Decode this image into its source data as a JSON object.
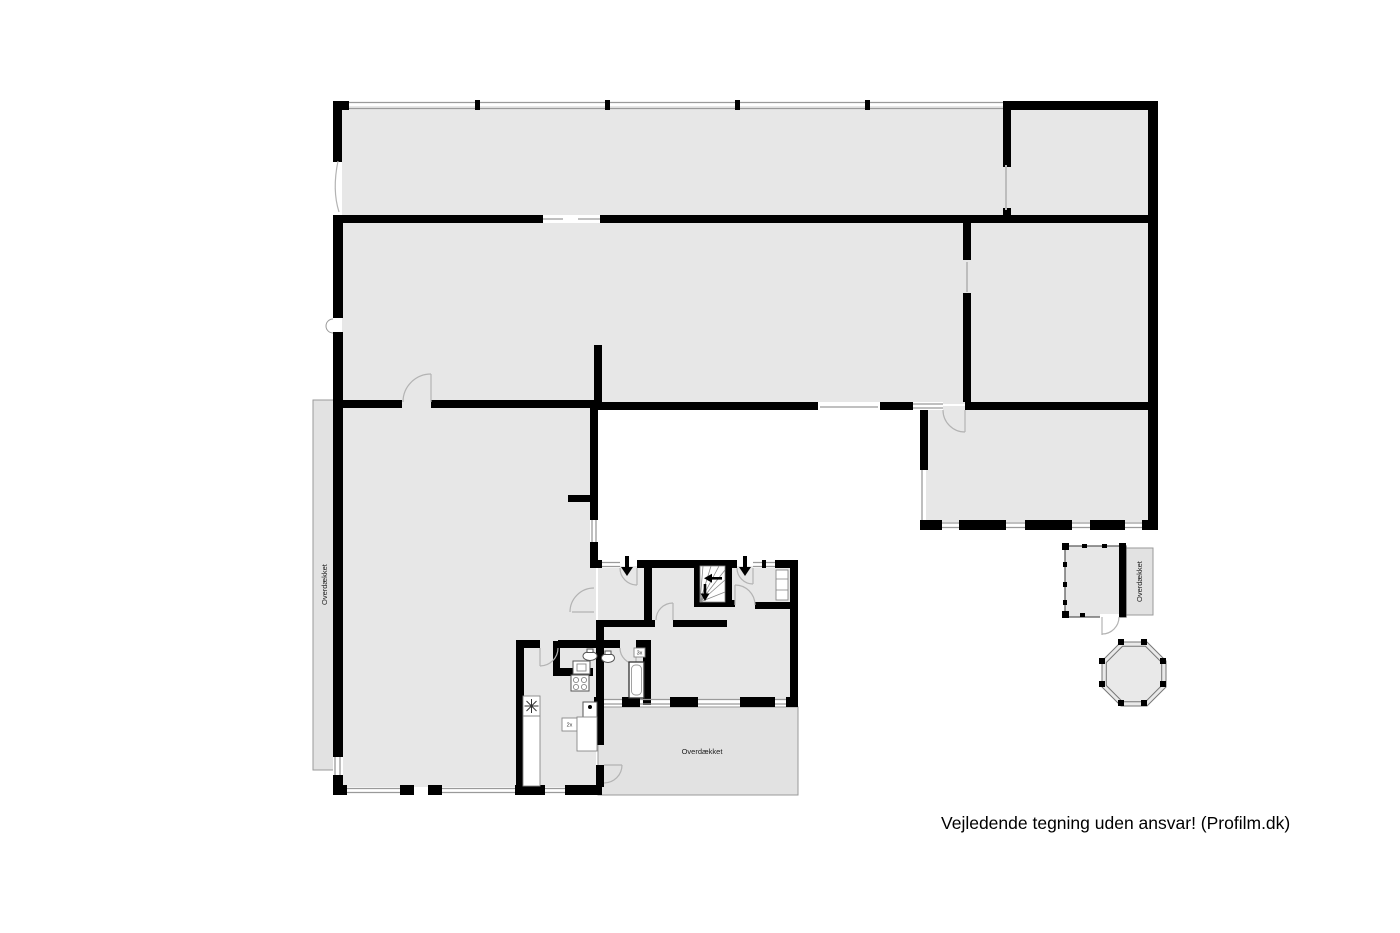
{
  "annotations": {
    "disclaimer": "Vejledende tegning uden ansvar! (Profilm.dk)"
  },
  "areas": {
    "left_covered_label": "Overdækket",
    "terrace_label": "Overdækket",
    "outbuilding_covered_label": "Overdækket"
  },
  "fixture_tags": {
    "tall_cabinet": "3x",
    "kitchen_unit": "2x"
  },
  "icons": {
    "entry_doors": "down-arrow",
    "stair_up": "left-arrow",
    "stair_down": "down-arrow",
    "freezer": "snowflake-icon"
  },
  "colors": {
    "walls": "#000000",
    "room_fill": "#e7e7e7",
    "covered_fill": "#e2e2e2",
    "outline": "#999999",
    "background": "#ffffff",
    "text": "#000000"
  }
}
